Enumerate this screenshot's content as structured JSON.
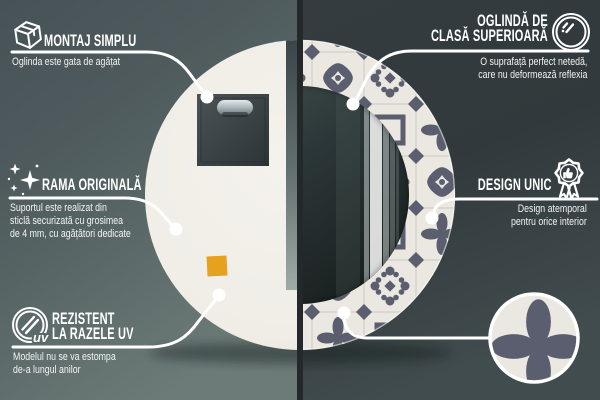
{
  "colors": {
    "callout_line": "#ffffff",
    "divider": "#24282a",
    "mirror_back": "#f1efe9",
    "pattern_motif": "#5a5e6f",
    "pattern_bg": "#ebe8e2",
    "pattern_grid": "#d5d2cb",
    "hanger_pad": "#e6a11e",
    "bg_left_top": "#465257",
    "bg_left_bottom": "#6d7b78",
    "bg_right_top": "#343c40",
    "bg_right_bottom": "#414c4e"
  },
  "callouts": [
    {
      "name": "montaj-simplu",
      "icon": "package-box-icon",
      "title_lines": [
        "MONTAJ SIMPLU"
      ],
      "desc_lines": [
        "Oglinda este gata de agățat"
      ]
    },
    {
      "name": "oglinda-de-clasa-superioara",
      "icon": "mirror-shine-icon",
      "title_lines": [
        "OGLINDĂ DE",
        "CLASĂ SUPERIOARĂ"
      ],
      "desc_lines": [
        "O suprafață perfect netedă,",
        "care nu deformează reflexia"
      ]
    },
    {
      "name": "rama-originala",
      "icon": "sparkles-icon",
      "title_lines": [
        "RAMA ORIGINALĂ"
      ],
      "desc_lines": [
        "Suportul este realizat din",
        "sticlă securizată cu grosimea",
        "de 4 mm, cu agățători dedicate"
      ]
    },
    {
      "name": "design-unic",
      "icon": "award-badge-icon",
      "title_lines": [
        "DESIGN UNIC"
      ],
      "desc_lines": [
        "Design atemporal",
        "pentru orice interior"
      ]
    },
    {
      "name": "rezistent-la-razele-uv",
      "icon": "uv-protection-icon",
      "icon_label": "uv",
      "title_lines": [
        "REZISTENT",
        "LA RAZELE UV"
      ],
      "desc_lines": [
        "Modelul nu se va estompa",
        "de-a lungul anilor"
      ]
    }
  ]
}
